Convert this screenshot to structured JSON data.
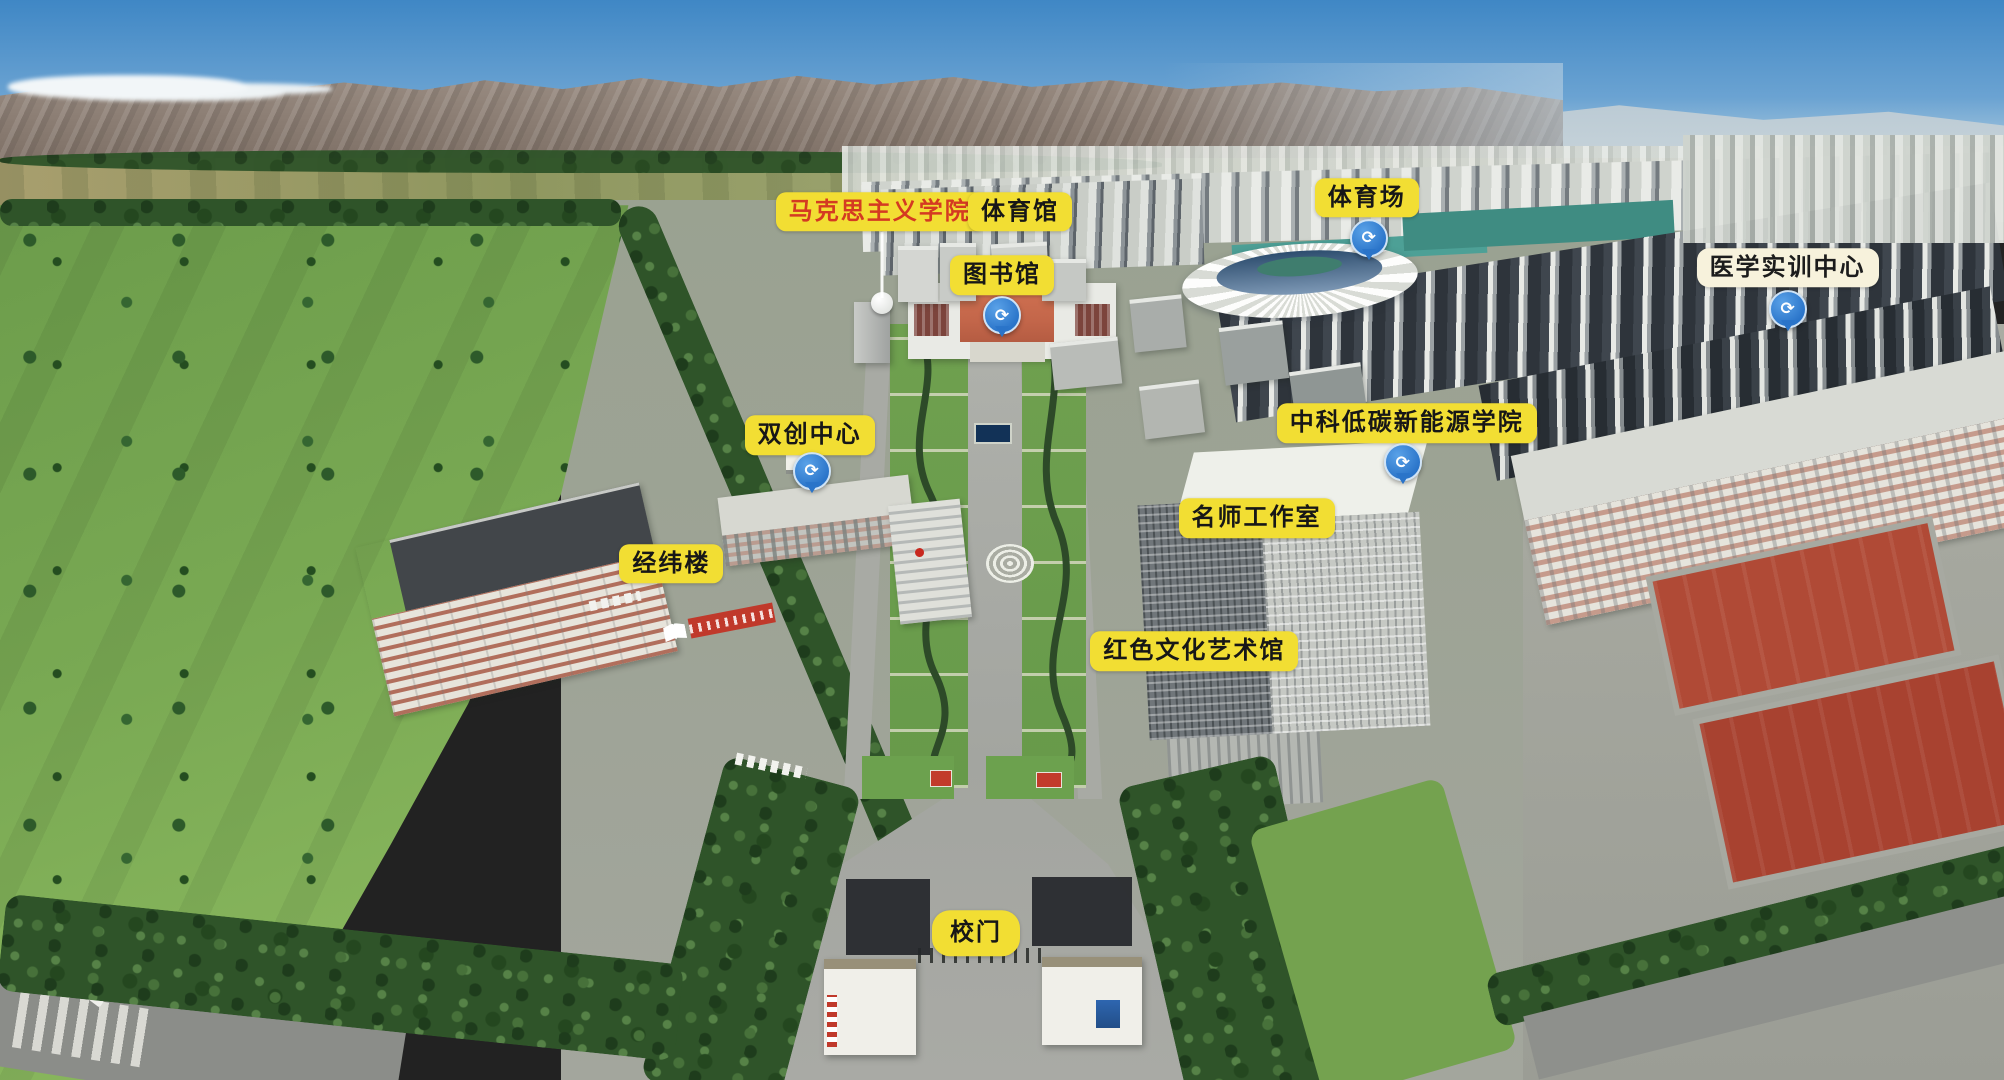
{
  "scene": {
    "description": "Aerial panoramic campus map with labeled buildings, mountains and city skyline",
    "colors": {
      "label_yellow": "#f2de33",
      "label_text_dark": "#171717",
      "label_text_red": "#d43a22",
      "label_cream": "#f7f2dc",
      "pin_blue": "#2d7dd2",
      "sky_top": "#3f87c5",
      "field_green": "#79a953",
      "stadium_white": "#f2f3ef",
      "court_red": "#b04a36"
    }
  },
  "map": {
    "pin_glyph": "⟳",
    "labels": [
      {
        "id": "marxism-college",
        "text": "马克思主义学院",
        "variant": "yellow-red",
        "x": 43.9,
        "y": 19.6,
        "leader": {
          "x": 44.0,
          "y1": 21.5,
          "y2": 27.6
        }
      },
      {
        "id": "gymnasium",
        "text": "体育馆",
        "variant": "yellow",
        "x": 50.9,
        "y": 19.6
      },
      {
        "id": "stadium",
        "text": "体育场",
        "variant": "yellow",
        "x": 68.2,
        "y": 18.3
      },
      {
        "id": "library",
        "text": "图书馆",
        "variant": "yellow",
        "x": 50.0,
        "y": 25.5
      },
      {
        "id": "medical-training-center",
        "text": "医学实训中心",
        "variant": "cream",
        "x": 89.2,
        "y": 24.8
      },
      {
        "id": "innovation-center",
        "text": "双创中心",
        "variant": "yellow",
        "x": 40.4,
        "y": 40.3
      },
      {
        "id": "cas-low-carbon-college",
        "text": "中科低碳新能源学院",
        "variant": "yellow",
        "x": 70.2,
        "y": 39.2
      },
      {
        "id": "master-teacher-studio",
        "text": "名师工作室",
        "variant": "yellow",
        "x": 62.7,
        "y": 48.0
      },
      {
        "id": "jingwei-building",
        "text": "经纬楼",
        "variant": "yellow",
        "x": 33.5,
        "y": 52.2
      },
      {
        "id": "red-culture-art-museum",
        "text": "红色文化艺术馆",
        "variant": "yellow",
        "x": 59.6,
        "y": 60.3
      },
      {
        "id": "school-gate",
        "text": "校门",
        "variant": "yellow-round",
        "x": 48.7,
        "y": 86.4
      }
    ],
    "pins": [
      {
        "id": "library-panorama-pin",
        "x": 50.0,
        "y": 31.6
      },
      {
        "id": "stadium-panorama-pin",
        "x": 68.3,
        "y": 24.4
      },
      {
        "id": "medical-panorama-pin",
        "x": 89.2,
        "y": 31.0
      },
      {
        "id": "innovation-panorama-pin",
        "x": 40.5,
        "y": 46.0
      },
      {
        "id": "studio-panorama-pin",
        "x": 70.0,
        "y": 45.2
      }
    ]
  }
}
